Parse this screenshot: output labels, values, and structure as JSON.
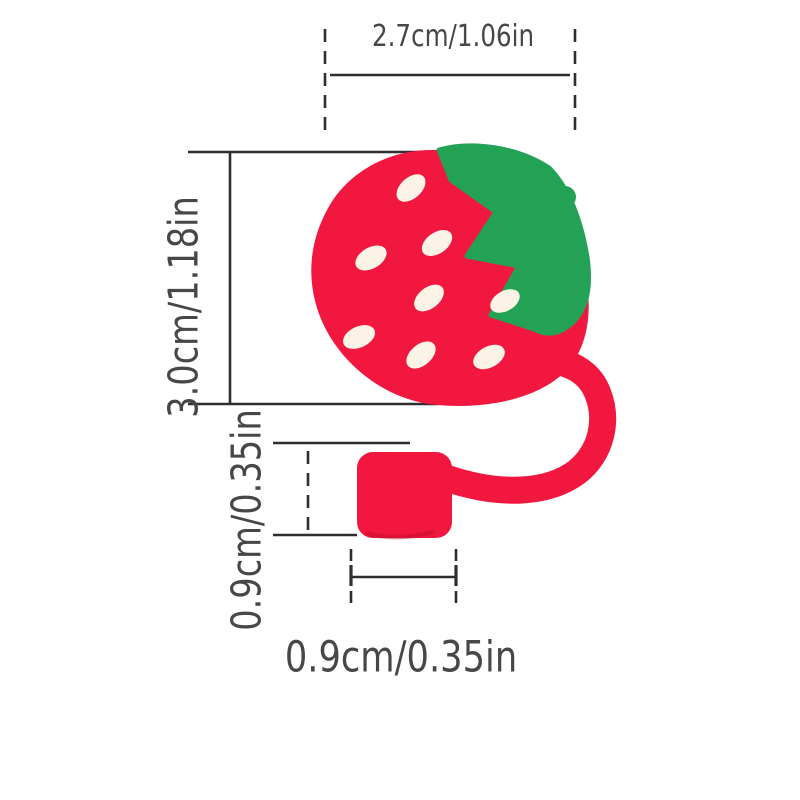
{
  "labels": {
    "top_width": "2.7cm/1.06in",
    "total_height": "3.0cm/1.18in",
    "cap_height": "0.9cm/0.35in",
    "cap_width": "0.9cm/0.35in"
  },
  "colors": {
    "berry_red": "#f2173f",
    "cap_shadow_red": "#c30d2e",
    "leaf_green": "#23a255",
    "seed_cream": "#fbf4e6",
    "line_color": "#2e2e2e",
    "text_color": "#474747",
    "background": "#ffffff"
  },
  "illustration": {
    "name": "strawberry-straw-topper",
    "parts": [
      "strawberry-body",
      "strawberry-leaf",
      "strawberry-stem",
      "strawberry-seeds",
      "straw-loop",
      "straw-cap"
    ]
  }
}
